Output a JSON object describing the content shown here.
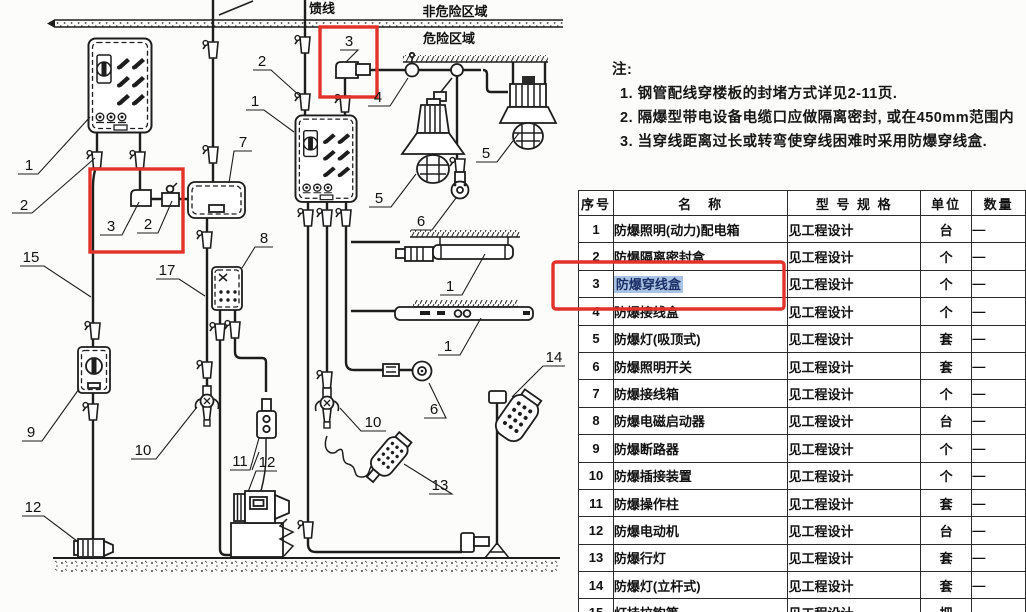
{
  "zones": {
    "feeder_label": "馈线",
    "non_hazardous": "非危险区域",
    "hazardous": "危险区域"
  },
  "notes": {
    "title": "注:",
    "items": [
      "1. 钢管配线穿楼板的封堵方式详见2-11页.",
      "2. 隔爆型带电设备电缆口应做隔离密封, 或在450mm范围内",
      "3. 当穿线距离过长或转弯使穿线困难时采用防爆穿线盒."
    ]
  },
  "callouts": {
    "c1_box_left": "1",
    "c2_stub_left": "2",
    "c15_conduit": "15",
    "c9_breaker": "9",
    "c12_motor_left": "12",
    "c3_elbow_left": "3",
    "c2_union_left": "2",
    "c17_conduit": "17",
    "c7_junction_box": "7",
    "c8_starter": "8",
    "c2_feeder": "2",
    "c1_box_mid": "1",
    "c3_elbow_top": "3",
    "c4_seal_fitting": "4",
    "c5_pendant_lamp": "5",
    "c5_ceiling_lamp": "5",
    "c6_switch_upper": "6",
    "c6_switch_lower": "6",
    "c1_fluorescent_upper": "1",
    "c1_fluorescent_lower": "1",
    "c10_plug_left": "10",
    "c10_plug_right": "10",
    "c11_socket": "11",
    "c12_motor_right": "12",
    "c13_hand_lamp": "13",
    "c14_pole_lamp": "14"
  },
  "table": {
    "headers": [
      "序号",
      "名　称",
      "型 号 规 格",
      "单位",
      "数量"
    ],
    "rows": [
      {
        "no": "1",
        "name": "防爆照明(动力)配电箱",
        "spec": "见工程设计",
        "unit": "台",
        "qty": "—"
      },
      {
        "no": "2",
        "name": "防爆隔离密封盒",
        "spec": "见工程设计",
        "unit": "个",
        "qty": "—"
      },
      {
        "no": "3",
        "name": "防爆穿线盒",
        "spec": "见工程设计",
        "unit": "个",
        "qty": "—"
      },
      {
        "no": "4",
        "name": "防爆接线盒",
        "spec": "见工程设计",
        "unit": "个",
        "qty": "—"
      },
      {
        "no": "5",
        "name": "防爆灯(吸顶式)",
        "spec": "见工程设计",
        "unit": "套",
        "qty": "—"
      },
      {
        "no": "6",
        "name": "防爆照明开关",
        "spec": "见工程设计",
        "unit": "套",
        "qty": "—"
      },
      {
        "no": "7",
        "name": "防爆接线箱",
        "spec": "见工程设计",
        "unit": "个",
        "qty": "—"
      },
      {
        "no": "8",
        "name": "防爆电磁启动器",
        "spec": "见工程设计",
        "unit": "台",
        "qty": "—"
      },
      {
        "no": "9",
        "name": "防爆断路器",
        "spec": "见工程设计",
        "unit": "个",
        "qty": "—"
      },
      {
        "no": "10",
        "name": "防爆插接装置",
        "spec": "见工程设计",
        "unit": "个",
        "qty": "—"
      },
      {
        "no": "11",
        "name": "防爆操作柱",
        "spec": "见工程设计",
        "unit": "套",
        "qty": "—"
      },
      {
        "no": "12",
        "name": "防爆电动机",
        "spec": "见工程设计",
        "unit": "台",
        "qty": "—"
      },
      {
        "no": "13",
        "name": "防爆行灯",
        "spec": "见工程设计",
        "unit": "套",
        "qty": "—"
      },
      {
        "no": "14",
        "name": "防爆灯(立杆式)",
        "spec": "见工程设计",
        "unit": "套",
        "qty": "—"
      },
      {
        "no": "15",
        "name": "灯挂拉钩等",
        "spec": "见工程设计",
        "unit": "把",
        "qty": "—"
      }
    ]
  },
  "colors": {
    "annotation_red": "#e2322a",
    "selection_blue": "#a9c3e4",
    "line_ink": "#1d1d1d"
  }
}
